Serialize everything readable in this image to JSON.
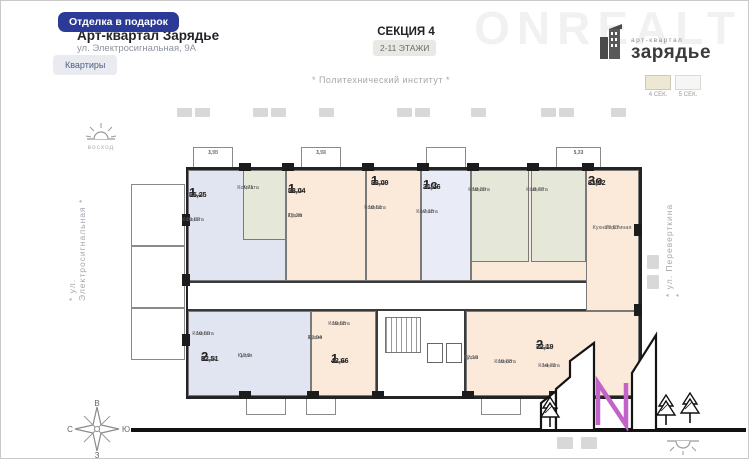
{
  "header": {
    "promo_badge": "Отделка в подарок",
    "title": "Арт-квартал Зарядье",
    "address": "ул. Электросигнальная, 9А",
    "apartments_button": "Квартиры",
    "section": "СЕКЦИЯ 4",
    "floors": "2-11 ЭТАЖИ",
    "watermark": "ONREALT"
  },
  "logo": {
    "brand_small": "арт-квартал",
    "brand_big": "зарядье"
  },
  "section_legend": {
    "current": "4 СЕК.",
    "other": "5 СЕК."
  },
  "surroundings": {
    "top_label": "* Политехнический институт *",
    "left_street": "* ул. Электросигнальная *",
    "right_street": "* ул. Переверткина *",
    "sunrise": "восход",
    "compass": {
      "top": "В",
      "left": "С",
      "right": "Ю",
      "bottom": "З"
    },
    "letter_n": "N"
  },
  "colors": {
    "accent_blue": "#2b3a97",
    "apartment_peach": "#fbe9da",
    "apartment_blue": "#e1e4f1",
    "apartment_green": "#e5e8d9",
    "magenta_n": "#c263c9"
  },
  "plan": {
    "balconies": [
      {
        "a": "3,50",
        "b": "1,75"
      },
      {
        "a": "3,52",
        "b": "1,76"
      },
      {
        "a": "5,32",
        "b": "1,73"
      }
    ],
    "apartments": [
      {
        "type": "1",
        "area_old": "53,47",
        "area": "55,25",
        "rooms": [
          {
            "name": "Комната",
            "area": "15,82"
          },
          {
            "name": "Комната",
            "area": "7,71"
          }
        ]
      },
      {
        "type": "1",
        "area_old": "50,28",
        "area": "58,04",
        "rooms": [
          {
            "name": "Кухня",
            "area": "15,26"
          }
        ]
      },
      {
        "type": "1",
        "area_old": "51,28",
        "area": "53,09",
        "rooms": [
          {
            "name": "Комната",
            "area": "18,51"
          }
        ]
      },
      {
        "type": "1с",
        "area_old": "29,95",
        "area": "31,46",
        "rooms": [
          {
            "name": "Комната",
            "area": "17,15"
          }
        ]
      },
      {
        "type": "3е",
        "area_old": "82,17",
        "area": "81,92",
        "rooms": [
          {
            "name": "Комната",
            "area": "18,39"
          },
          {
            "name": "Комната",
            "area": "18,77"
          },
          {
            "name": "Кухня-гостиная",
            "area": "25,87"
          }
        ]
      },
      {
        "type": "2",
        "area_old": "50,24",
        "area": "52,51",
        "rooms": [
          {
            "name": "Комната",
            "area": "16,59"
          },
          {
            "name": "Кухня",
            "area": "10,9"
          }
        ]
      },
      {
        "type": "1",
        "area_old": "45,19",
        "area": "42,66",
        "rooms": [
          {
            "name": "Кухня",
            "area": "13,04"
          },
          {
            "name": "Комната",
            "area": "15,55"
          }
        ]
      },
      {
        "type": "2",
        "area_old": "68,80",
        "area": "72,19",
        "rooms": [
          {
            "name": "Кухня",
            "area": "12,10"
          },
          {
            "name": "Комната",
            "area": "15,83"
          },
          {
            "name": "Комната",
            "area": "14,71"
          }
        ]
      }
    ]
  }
}
